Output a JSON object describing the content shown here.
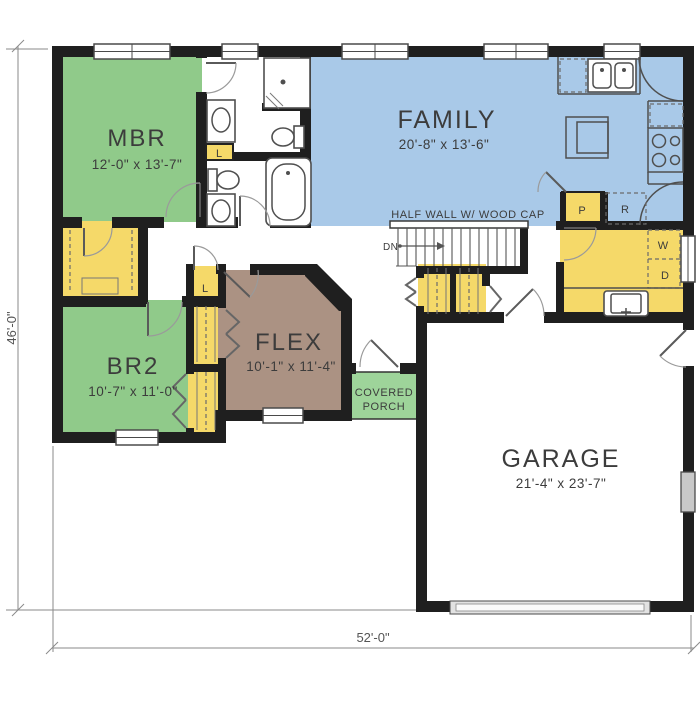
{
  "plan": {
    "title": "single-story floor plan",
    "rooms": [
      {
        "name": "MBR",
        "dims": "12'-0\" x 13'-7\""
      },
      {
        "name": "FAMILY",
        "dims": "20'-8\" x 13'-6\""
      },
      {
        "name": "BR2",
        "dims": "10'-7\" x 11'-0\""
      },
      {
        "name": "FLEX",
        "dims": "10'-1\" x 11'-4\""
      },
      {
        "name": "GARAGE",
        "dims": "21'-4\" x 23'-7\""
      }
    ],
    "porch": {
      "line1": "COVERED",
      "line2": "PORCH"
    },
    "notes": {
      "half_wall": "HALF WALL W/ WOOD CAP",
      "down": "DN"
    },
    "fixtures": {
      "pantry": "P",
      "refrigerator": "R",
      "washer": "W",
      "dryer": "D",
      "linen_bath": "L",
      "linen_hall": "L"
    },
    "dimensions": {
      "height": "46'-0\"",
      "width": "52'-0\""
    },
    "colors": {
      "wall": "#1f1f1f",
      "green": "#90ca8a",
      "porch": "#9ed49a",
      "yellow": "#f5d969",
      "blue": "#a9c9e8",
      "brown": "#ab9283",
      "fx": "#4f4f4f",
      "dim": "#8a8a8a",
      "text": "#3c3c3c"
    }
  }
}
